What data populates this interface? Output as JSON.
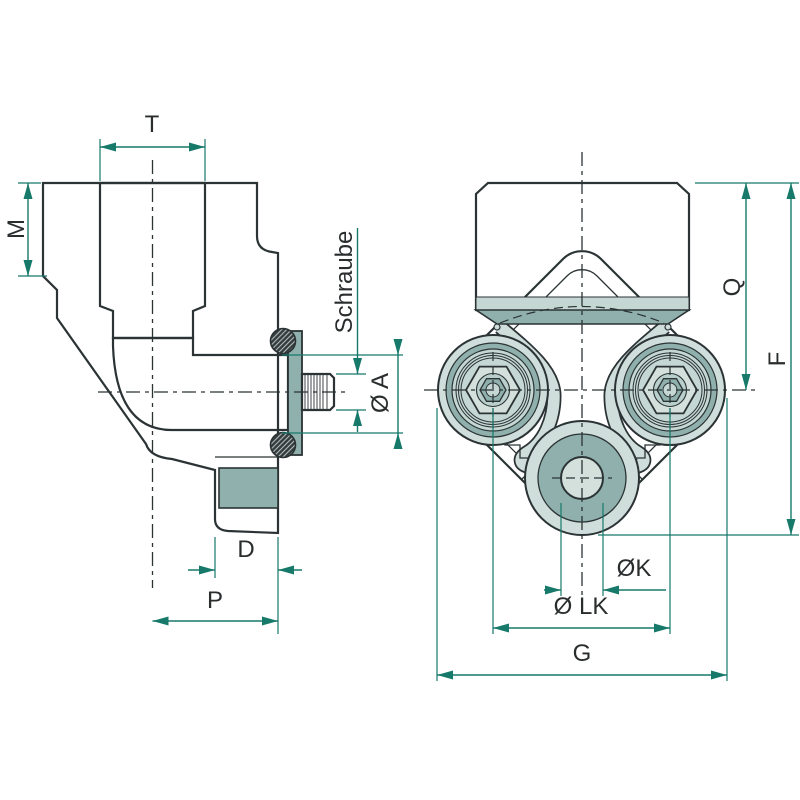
{
  "drawing": {
    "title": "hydraulic elbow flange fitting - technical drawing",
    "colors": {
      "outline": "#2b3335",
      "dimension": "#16796a",
      "label_text": "#2a2d2e",
      "hatch_background": "#d9e4e0",
      "solid_fill": "#8fb0ac",
      "light_fill": "#cfdeda",
      "band_fill": "#c5d7d3",
      "oring_fill": "#333b3d"
    },
    "views": {
      "side_section": {
        "name": "side section view",
        "dimensions": {
          "T": "T",
          "M": "M",
          "Schraube": "Schraube",
          "OA": "Ø A",
          "D": "D",
          "P": "P"
        }
      },
      "front": {
        "name": "front view",
        "dimensions": {
          "Q": "Q",
          "F": "F",
          "OK": "ØK",
          "OLK": "Ø LK",
          "G": "G"
        }
      }
    }
  }
}
